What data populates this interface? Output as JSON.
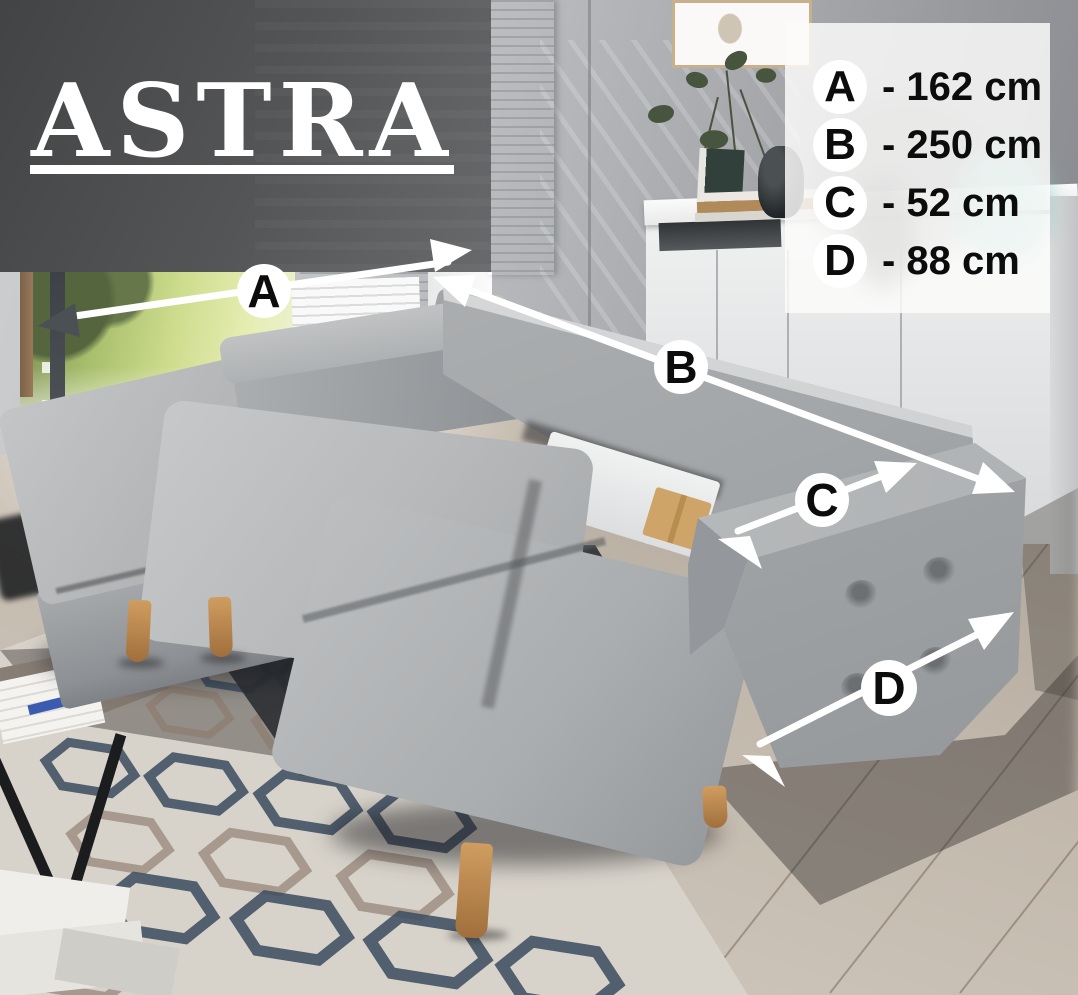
{
  "title": {
    "text": "ASTRA"
  },
  "legend": {
    "items": [
      {
        "letter": "A",
        "value": "- 162 cm"
      },
      {
        "letter": "B",
        "value": "- 250 cm"
      },
      {
        "letter": "C",
        "value": "- 52 cm"
      },
      {
        "letter": "D",
        "value": "- 88 cm"
      }
    ]
  },
  "colors": {
    "overlay_gray": "#4a4c4e",
    "arrow_white": "#ffffff",
    "arrowhead_dark": "#4b5054",
    "sofa_gray": "#aaadaf",
    "rug_navy": "#3f5063",
    "rug_taupe": "#8d7b6d",
    "wood_leg": "#c18a50",
    "teal_vase": "#8fccc6"
  }
}
